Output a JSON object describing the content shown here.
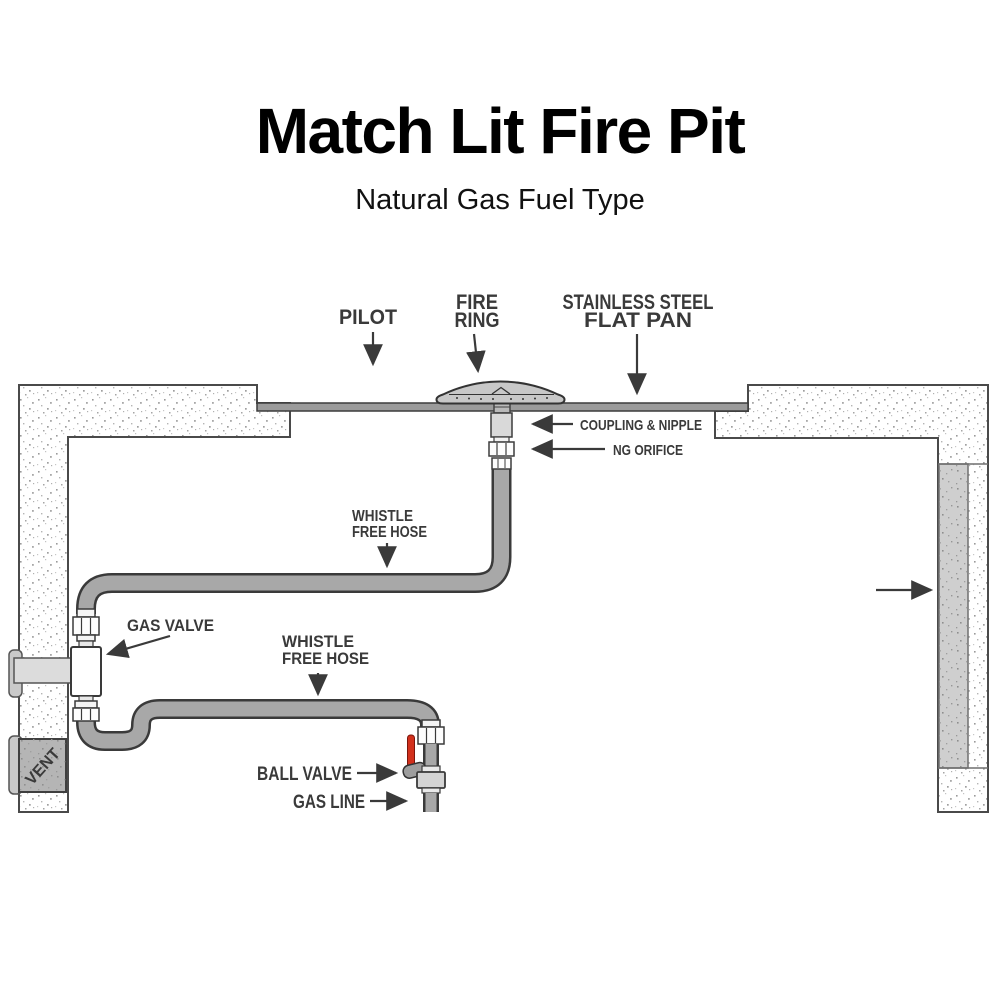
{
  "header": {
    "title": "Match Lit Fire Pit",
    "subtitle": "Natural Gas Fuel Type"
  },
  "callouts": {
    "pilot": "PILOT",
    "fire_ring_1": "FIRE",
    "fire_ring_2": "RING",
    "flat_pan_1": "STAINLESS STEEL",
    "flat_pan_2": "FLAT PAN",
    "coupling_nipple": "COUPLING & NIPPLE",
    "ng_orifice": "NG ORIFICE",
    "whistle_upper_1": "WHISTLE",
    "whistle_upper_2": "FREE HOSE",
    "gas_valve": "GAS VALVE",
    "whistle_lower_1": "WHISTLE",
    "whistle_lower_2": "FREE HOSE",
    "ball_valve": "BALL VALVE",
    "gas_line": "GAS LINE",
    "vent": "VENT"
  },
  "colors": {
    "label_text": "#3a3a3a",
    "title_text": "#000000",
    "hose_gray": "#a8a8a8",
    "pan_gray": "#9b9b9b",
    "vent_gray": "#b5b5b5",
    "wall_inner_panel_gray": "#cfcfcf",
    "ball_valve_handle_red": "#d2301c"
  }
}
